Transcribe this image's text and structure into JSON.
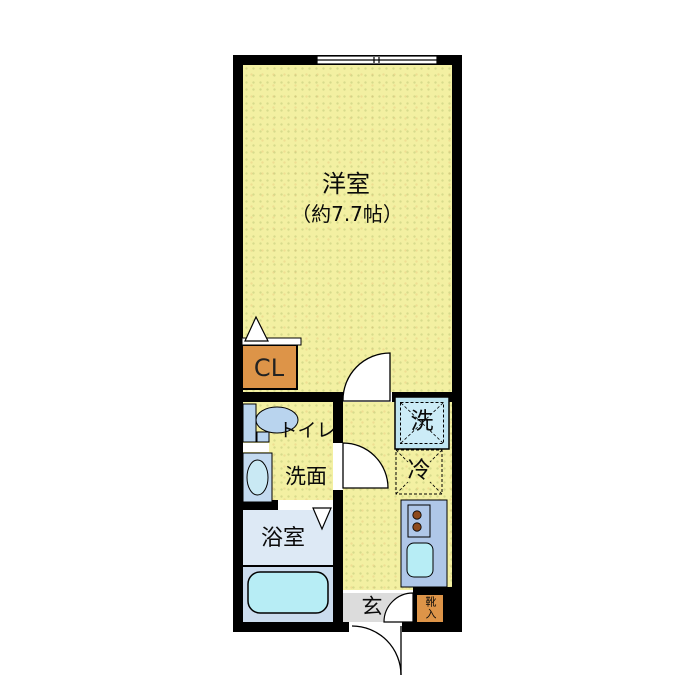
{
  "floorplan": {
    "labels": {
      "main_room": "洋室",
      "main_room_size": "（約7.7帖）",
      "closet": "CL",
      "toilet": "トイレ",
      "washroom": "洗面",
      "bathroom": "浴室",
      "washer": "洗",
      "fridge": "冷",
      "entrance": "玄",
      "shoe_storage": "靴入"
    },
    "colors": {
      "floor": "#f3f0a2",
      "wall": "#000000",
      "closet": "#dd9448",
      "shoe_storage": "#dd9448",
      "bathroom_upper": "#dde9f5",
      "bathroom_lower": "#cbdcee",
      "bathtub": "#b7edf5",
      "fixtures_blue": "#b9d4ee",
      "sink_unit": "#c3daf0",
      "kitchen_unit": "#afc7e8",
      "washer_box": "#bfe5f1",
      "entrance_floor": "#dcdcdc",
      "burner": "#8d4a1d"
    }
  }
}
